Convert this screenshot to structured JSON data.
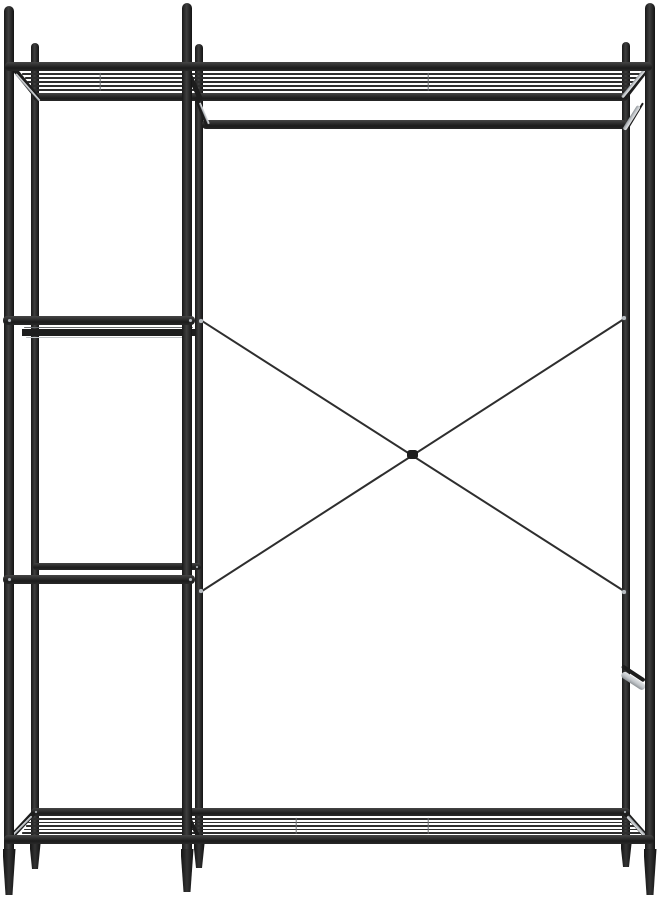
{
  "meta": {
    "description": "Black metal open wardrobe garment rack with left ladder shelves, top wire shelf, hanging rod, crossed rear cable braces and bottom wire shelf, on a plain white background",
    "background": "#ffffff"
  },
  "palette": {
    "background": "#ffffff",
    "steel_dark": "#1d1d1d",
    "steel_mid": "#2e2e2e",
    "silver": "#c0c4c8",
    "silver_shadow": "#8d9296",
    "bolt": "#b9bec3"
  },
  "scene": {
    "width": 657,
    "height": 900,
    "elements": [
      {
        "name": "back-left-post",
        "kind": "rect",
        "x": 31,
        "y": 43,
        "w": 8,
        "h": 802,
        "r": "4px 4px 0 0",
        "cls": "post",
        "z": 2
      },
      {
        "name": "back-middle-post",
        "kind": "rect",
        "x": 195,
        "y": 44,
        "w": 8,
        "h": 801,
        "r": "4px 4px 0 0",
        "cls": "post",
        "z": 2
      },
      {
        "name": "back-right-post",
        "kind": "rect",
        "x": 622,
        "y": 42,
        "w": 8,
        "h": 803,
        "r": "4px 4px 0 0",
        "cls": "post",
        "z": 2
      },
      {
        "name": "back-left-foot",
        "kind": "poly",
        "points": [
          [
            29.5,
            844
          ],
          [
            40.5,
            844
          ],
          [
            38,
            869
          ],
          [
            32,
            869
          ]
        ],
        "cls": "foot",
        "z": 2
      },
      {
        "name": "back-middle-foot",
        "kind": "poly",
        "points": [
          [
            193.5,
            844
          ],
          [
            204.5,
            844
          ],
          [
            202,
            868
          ],
          [
            196,
            868
          ]
        ],
        "cls": "foot",
        "z": 2
      },
      {
        "name": "back-right-foot",
        "kind": "poly",
        "points": [
          [
            620.5,
            844
          ],
          [
            631.5,
            844
          ],
          [
            629,
            867
          ],
          [
            623,
            867
          ]
        ],
        "cls": "foot",
        "z": 2
      },
      {
        "name": "top-shelf-back-rail",
        "kind": "rect",
        "x": 33,
        "y": 93,
        "w": 595,
        "h": 8,
        "r": "4px",
        "cls": "rail",
        "z": 3
      },
      {
        "name": "hanging-rod",
        "kind": "rect",
        "x": 202,
        "y": 120,
        "w": 424,
        "h": 9,
        "r": "4px",
        "cls": "rail",
        "z": 3
      },
      {
        "name": "left-shelf-2-back-rail",
        "kind": "rect",
        "x": 22,
        "y": 329,
        "w": 173,
        "h": 7,
        "cls": "dark",
        "z": 3
      },
      {
        "name": "left-shelf-3-back-rail",
        "kind": "rect",
        "x": 33,
        "y": 563,
        "w": 168,
        "h": 7,
        "r": "3px",
        "cls": "rail",
        "z": 3
      },
      {
        "name": "bottom-shelf-back-rail",
        "kind": "rect",
        "x": 31,
        "y": 808,
        "w": 599,
        "h": 8,
        "r": "4px",
        "cls": "rail",
        "z": 3
      },
      {
        "name": "top-shelf-wire-1",
        "kind": "line",
        "x1": 22,
        "y1": 74,
        "x2": 640,
        "y2": 74,
        "th": 1.6,
        "cls": "wire",
        "z": 4
      },
      {
        "name": "top-shelf-wire-2",
        "kind": "line",
        "x1": 25,
        "y1": 78,
        "x2": 637,
        "y2": 78,
        "th": 1.6,
        "cls": "wire",
        "z": 4
      },
      {
        "name": "top-shelf-wire-3",
        "kind": "line",
        "x1": 27,
        "y1": 82,
        "x2": 635,
        "y2": 82,
        "th": 1.6,
        "cls": "wire",
        "z": 4
      },
      {
        "name": "top-shelf-wire-4",
        "kind": "line",
        "x1": 29,
        "y1": 86,
        "x2": 633,
        "y2": 86,
        "th": 1.6,
        "cls": "wire",
        "z": 4
      },
      {
        "name": "top-shelf-wire-5",
        "kind": "line",
        "x1": 31,
        "y1": 90,
        "x2": 631,
        "y2": 90,
        "th": 1.6,
        "cls": "wire",
        "z": 4
      },
      {
        "name": "bottom-shelf-wire-1",
        "kind": "line",
        "x1": 30,
        "y1": 819,
        "x2": 630,
        "y2": 819,
        "th": 1.6,
        "cls": "wire",
        "z": 4
      },
      {
        "name": "bottom-shelf-wire-2",
        "kind": "line",
        "x1": 28,
        "y1": 822.5,
        "x2": 633,
        "y2": 822.5,
        "th": 1.6,
        "cls": "wire",
        "z": 4
      },
      {
        "name": "bottom-shelf-wire-3",
        "kind": "line",
        "x1": 26,
        "y1": 826,
        "x2": 636,
        "y2": 826,
        "th": 1.6,
        "cls": "wire",
        "z": 4
      },
      {
        "name": "bottom-shelf-wire-4",
        "kind": "line",
        "x1": 24,
        "y1": 829.5,
        "x2": 639,
        "y2": 829.5,
        "th": 1.6,
        "cls": "wire",
        "z": 4
      },
      {
        "name": "bottom-shelf-wire-5",
        "kind": "line",
        "x1": 22,
        "y1": 833,
        "x2": 641,
        "y2": 833,
        "th": 1.6,
        "cls": "wire",
        "z": 4
      },
      {
        "name": "left-shelf-2-edge-highlight",
        "kind": "line",
        "x1": 24,
        "y1": 327.5,
        "x2": 193,
        "y2": 327.5,
        "th": 1.2,
        "cls": "tick",
        "z": 4
      },
      {
        "name": "left-shelf-2-front-edge",
        "kind": "line",
        "x1": 26,
        "y1": 337.5,
        "x2": 190,
        "y2": 337.5,
        "th": 1.4,
        "cls": "silver",
        "z": 4
      },
      {
        "name": "cross-brace-1",
        "kind": "line",
        "x1": 202,
        "y1": 321,
        "x2": 624,
        "y2": 591,
        "th": 1.8,
        "cls": "wire",
        "z": 4
      },
      {
        "name": "cross-brace-2",
        "kind": "line",
        "x1": 202,
        "y1": 591,
        "x2": 624,
        "y2": 319,
        "th": 1.8,
        "cls": "wire",
        "z": 4
      },
      {
        "name": "cross-brace-knot",
        "kind": "rect",
        "x": 407,
        "y": 450,
        "w": 11,
        "h": 9,
        "r": "3px",
        "cls": "dark",
        "z": 4
      },
      {
        "name": "top-shelf-left-side",
        "kind": "line",
        "x1": 13,
        "y1": 67,
        "x2": 38,
        "y2": 98,
        "th": 5,
        "cls": "dark",
        "z": 5
      },
      {
        "name": "top-shelf-left-side-glint",
        "kind": "line",
        "x1": 16,
        "y1": 74,
        "x2": 40,
        "y2": 101,
        "th": 1.5,
        "cls": "silver",
        "z": 5
      },
      {
        "name": "top-shelf-middle-side",
        "kind": "line",
        "x1": 187,
        "y1": 69,
        "x2": 201,
        "y2": 100,
        "th": 5,
        "cls": "dark",
        "z": 5
      },
      {
        "name": "rod-left-bracket",
        "kind": "line",
        "x1": 196,
        "y1": 97,
        "x2": 208,
        "y2": 127,
        "th": 4,
        "cls": "dark",
        "z": 5
      },
      {
        "name": "rod-left-bracket-glint",
        "kind": "line",
        "x1": 200,
        "y1": 103,
        "x2": 209,
        "y2": 124,
        "th": 1.5,
        "cls": "silver",
        "z": 5
      },
      {
        "name": "top-shelf-right-side",
        "kind": "line",
        "x1": 648,
        "y1": 67,
        "x2": 624,
        "y2": 98,
        "th": 5,
        "cls": "dark",
        "z": 5
      },
      {
        "name": "top-shelf-right-side-glint",
        "kind": "line",
        "x1": 645,
        "y1": 69,
        "x2": 622,
        "y2": 97,
        "th": 3,
        "cls": "silver",
        "z": 5
      },
      {
        "name": "rod-right-bracket",
        "kind": "line",
        "x1": 643,
        "y1": 103,
        "x2": 628,
        "y2": 128,
        "th": 2,
        "cls": "dark",
        "z": 5
      },
      {
        "name": "rod-right-bracket-glint",
        "kind": "line",
        "x1": 639,
        "y1": 106,
        "x2": 624,
        "y2": 130,
        "th": 4,
        "cls": "silver",
        "z": 5
      },
      {
        "name": "bottom-shelf-left-side",
        "kind": "line",
        "x1": 9,
        "y1": 839,
        "x2": 34,
        "y2": 812,
        "th": 5,
        "cls": "dark",
        "z": 5
      },
      {
        "name": "bottom-shelf-left-side-glint",
        "kind": "line",
        "x1": 12,
        "y1": 836,
        "x2": 32,
        "y2": 816,
        "th": 2,
        "cls": "silver",
        "z": 5
      },
      {
        "name": "bottom-shelf-middle-side",
        "kind": "line",
        "x1": 186,
        "y1": 812,
        "x2": 199,
        "y2": 838,
        "th": 4,
        "cls": "dark",
        "z": 5
      },
      {
        "name": "bottom-shelf-right-side",
        "kind": "line",
        "x1": 649,
        "y1": 839,
        "x2": 625,
        "y2": 812,
        "th": 5,
        "cls": "dark",
        "z": 5
      },
      {
        "name": "bottom-shelf-right-side-glint",
        "kind": "line",
        "x1": 646,
        "y1": 837,
        "x2": 627,
        "y2": 816,
        "th": 2.5,
        "cls": "silver",
        "z": 5
      },
      {
        "name": "right-post-bracket-shadow",
        "kind": "line",
        "x1": 622,
        "y1": 666,
        "x2": 645,
        "y2": 681,
        "th": 4,
        "cls": "dark",
        "z": 5
      },
      {
        "name": "right-post-bracket",
        "kind": "line",
        "x1": 622,
        "y1": 673,
        "x2": 645,
        "y2": 688,
        "th": 7,
        "cls": "silver",
        "z": 5
      },
      {
        "name": "top-mesh-cross-wire-1",
        "kind": "line",
        "x1": 100,
        "y1": 73,
        "x2": 100,
        "y2": 91,
        "th": 1.4,
        "cls": "tick",
        "z": 5
      },
      {
        "name": "top-mesh-cross-wire-2",
        "kind": "line",
        "x1": 428,
        "y1": 73,
        "x2": 428,
        "y2": 91,
        "th": 1.4,
        "cls": "tick",
        "z": 5
      },
      {
        "name": "bottom-mesh-cross-wire-1",
        "kind": "line",
        "x1": 296,
        "y1": 818,
        "x2": 296,
        "y2": 834,
        "th": 1.4,
        "cls": "tick",
        "z": 5
      },
      {
        "name": "bottom-mesh-cross-wire-2",
        "kind": "line",
        "x1": 428,
        "y1": 818,
        "x2": 428,
        "y2": 834,
        "th": 1.4,
        "cls": "tick",
        "z": 5
      },
      {
        "name": "front-left-post",
        "kind": "rect",
        "x": 4,
        "y": 6,
        "w": 10,
        "h": 846,
        "r": "5px 5px 0 0",
        "cls": "post",
        "z": 6
      },
      {
        "name": "front-middle-post",
        "kind": "rect",
        "x": 182,
        "y": 3,
        "w": 10,
        "h": 849,
        "r": "5px 5px 0 0",
        "cls": "post",
        "z": 6
      },
      {
        "name": "front-right-post",
        "kind": "rect",
        "x": 645,
        "y": 3,
        "w": 10,
        "h": 849,
        "r": "5px 5px 0 0",
        "cls": "post",
        "z": 6
      },
      {
        "name": "front-left-foot",
        "kind": "poly",
        "points": [
          [
            2.5,
            849
          ],
          [
            15.5,
            849
          ],
          [
            12.5,
            895
          ],
          [
            5.5,
            895
          ]
        ],
        "cls": "foot",
        "z": 6
      },
      {
        "name": "front-middle-foot",
        "kind": "poly",
        "points": [
          [
            180.5,
            849
          ],
          [
            193.5,
            849
          ],
          [
            190.5,
            892
          ],
          [
            183.5,
            892
          ]
        ],
        "cls": "foot",
        "z": 6
      },
      {
        "name": "front-right-foot",
        "kind": "poly",
        "points": [
          [
            643.5,
            849
          ],
          [
            656.5,
            849
          ],
          [
            653.5,
            895
          ],
          [
            646.5,
            895
          ]
        ],
        "cls": "foot",
        "z": 6
      },
      {
        "name": "top-shelf-front-rail",
        "kind": "rect",
        "x": 5,
        "y": 62,
        "w": 647,
        "h": 9,
        "r": "4px",
        "cls": "rail",
        "z": 7
      },
      {
        "name": "left-shelf-2-front-rail",
        "kind": "rect",
        "x": 3,
        "y": 316,
        "w": 192,
        "h": 9,
        "r": "4px",
        "cls": "rail",
        "z": 7
      },
      {
        "name": "left-shelf-3-front-rail",
        "kind": "rect",
        "x": 3,
        "y": 575,
        "w": 192,
        "h": 9,
        "r": "4px",
        "cls": "rail",
        "z": 7
      },
      {
        "name": "bottom-shelf-front-rail",
        "kind": "rect",
        "x": 4,
        "y": 835,
        "w": 650,
        "h": 9,
        "r": "4px",
        "cls": "rail",
        "z": 7
      },
      {
        "name": "brace-bolt-top-left",
        "kind": "dot",
        "cx": 201,
        "cy": 321,
        "d": 3.5,
        "cls": "bolt",
        "z": 8
      },
      {
        "name": "brace-bolt-bottom-left",
        "kind": "dot",
        "cx": 201,
        "cy": 591,
        "d": 3.5,
        "cls": "bolt",
        "z": 8
      },
      {
        "name": "brace-bolt-top-right",
        "kind": "dot",
        "cx": 624,
        "cy": 318,
        "d": 3.5,
        "cls": "bolt",
        "z": 8
      },
      {
        "name": "brace-bolt-bottom-right",
        "kind": "dot",
        "cx": 624,
        "cy": 592,
        "d": 3.5,
        "cls": "bolt",
        "z": 8
      },
      {
        "name": "shelf-2-bolt-left",
        "kind": "dot",
        "cx": 9,
        "cy": 320.5,
        "d": 3,
        "cls": "bolt",
        "z": 8
      },
      {
        "name": "shelf-2-bolt-right",
        "kind": "dot",
        "cx": 190,
        "cy": 320.5,
        "d": 3,
        "cls": "bolt",
        "z": 8
      },
      {
        "name": "shelf-3-bolt-left",
        "kind": "dot",
        "cx": 9,
        "cy": 579.5,
        "d": 3,
        "cls": "bolt",
        "z": 8
      },
      {
        "name": "shelf-3-bolt-right",
        "kind": "dot",
        "cx": 190,
        "cy": 579.5,
        "d": 3,
        "cls": "bolt",
        "z": 8
      },
      {
        "name": "shelf-3-back-bolt",
        "kind": "dot",
        "cx": 197,
        "cy": 567,
        "d": 2.6,
        "cls": "bolt",
        "z": 8
      },
      {
        "name": "bottom-rail-bolt-left",
        "kind": "dot",
        "cx": 36,
        "cy": 812,
        "d": 2.6,
        "cls": "bolt",
        "z": 8
      },
      {
        "name": "bottom-rail-bolt-right",
        "kind": "dot",
        "cx": 625,
        "cy": 812,
        "d": 2.6,
        "cls": "bolt",
        "z": 8
      }
    ]
  }
}
